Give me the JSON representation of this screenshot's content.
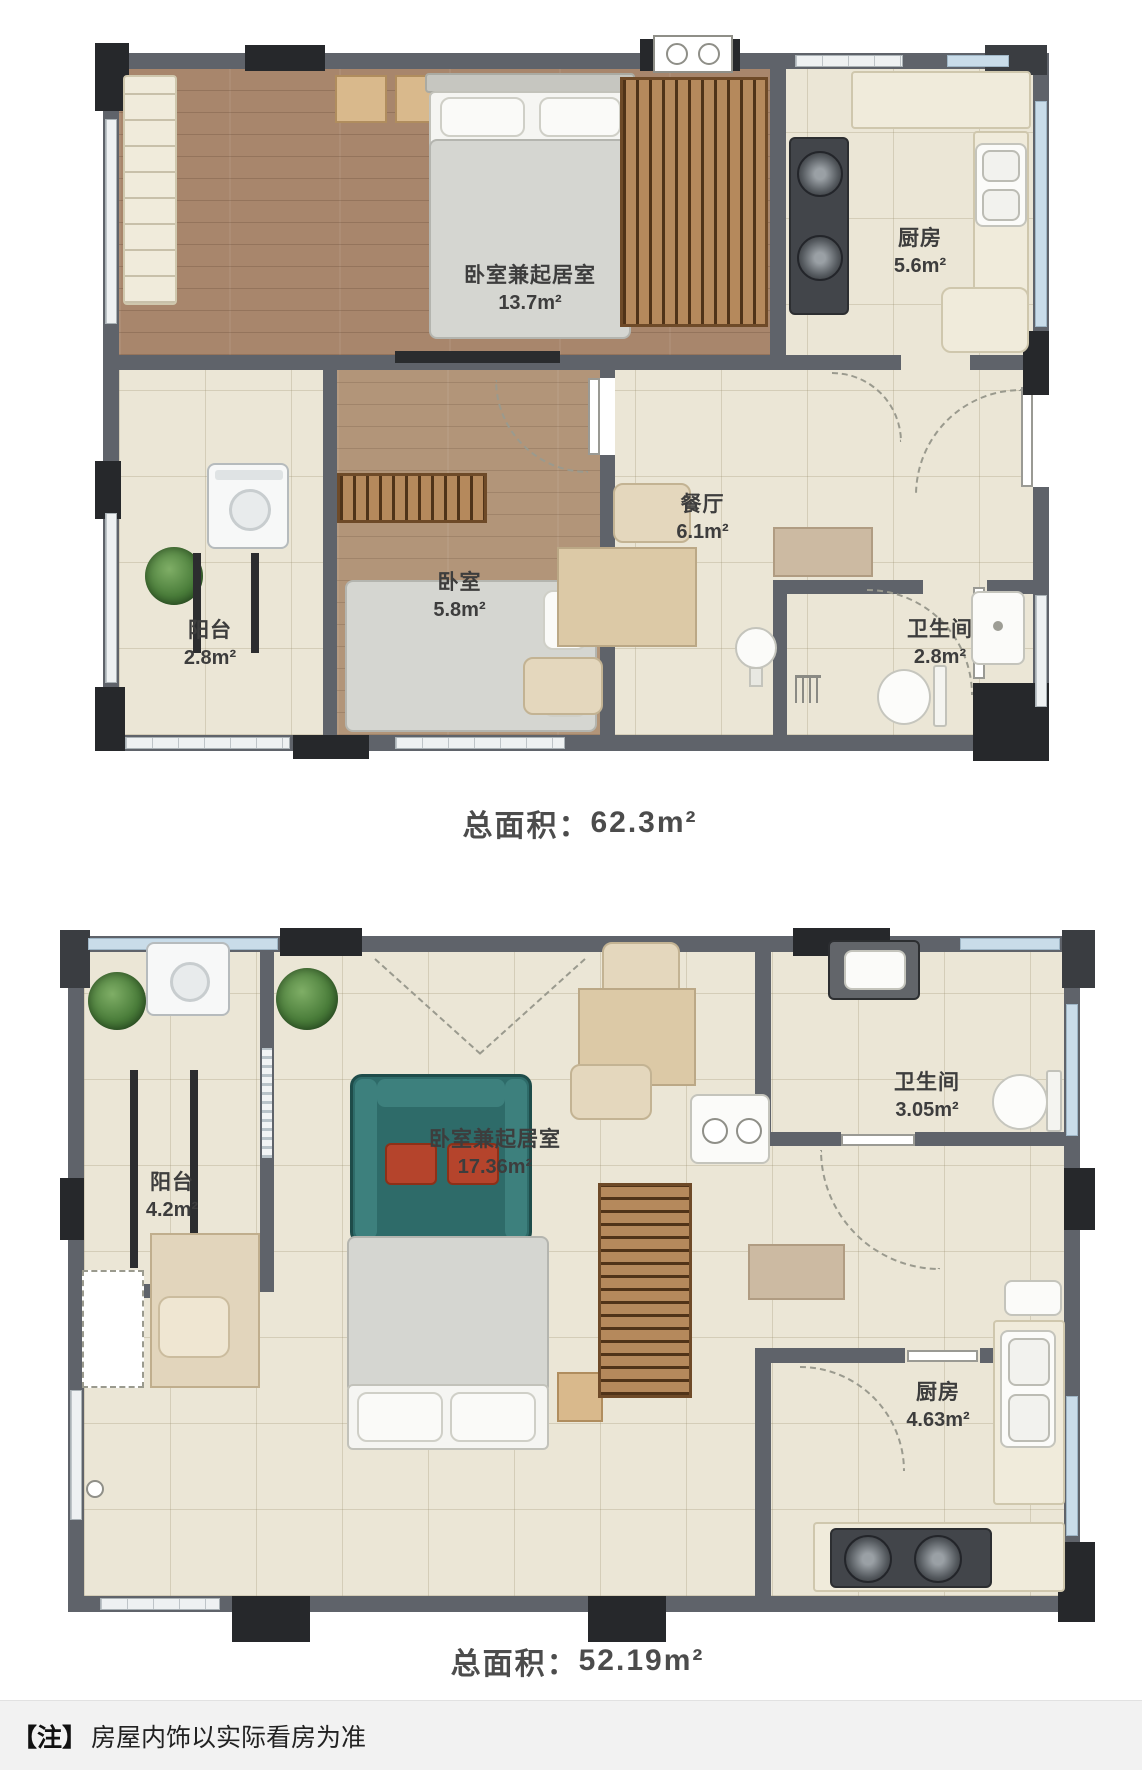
{
  "plan1": {
    "total_label": "总面积：",
    "total_value": "62.3m²",
    "rooms": {
      "master": {
        "name": "卧室兼起居室",
        "area": "13.7m²"
      },
      "kitchen": {
        "name": "厨房",
        "area": "5.6m²"
      },
      "dining": {
        "name": "餐厅",
        "area": "6.1m²"
      },
      "bedroom": {
        "name": "卧室",
        "area": "5.8m²"
      },
      "balcony": {
        "name": "阳台",
        "area": "2.8m²"
      },
      "bathroom": {
        "name": "卫生间",
        "area": "2.8m²"
      }
    }
  },
  "plan2": {
    "total_label": "总面积：",
    "total_value": "52.19m²",
    "rooms": {
      "balcony": {
        "name": "阳台",
        "area": "4.2m²"
      },
      "main": {
        "name": "卧室兼起居室",
        "area": "17.36m²"
      },
      "bathroom": {
        "name": "卫生间",
        "area": "3.05m²"
      },
      "kitchen": {
        "name": "厨房",
        "area": "4.63m²"
      }
    }
  },
  "footer": {
    "tag": "【注】",
    "text": "房屋内饰以实际看房为准"
  },
  "colors": {
    "wall": "#5f636a",
    "pillar": "#26282b",
    "wood_floor": "#a8866c",
    "tile_floor": "#ebe6d6",
    "sofa": "#2e6b69",
    "cushion": "#b5442c",
    "window_glass": "#c9dce9",
    "label_text": "#3d3d3d"
  }
}
